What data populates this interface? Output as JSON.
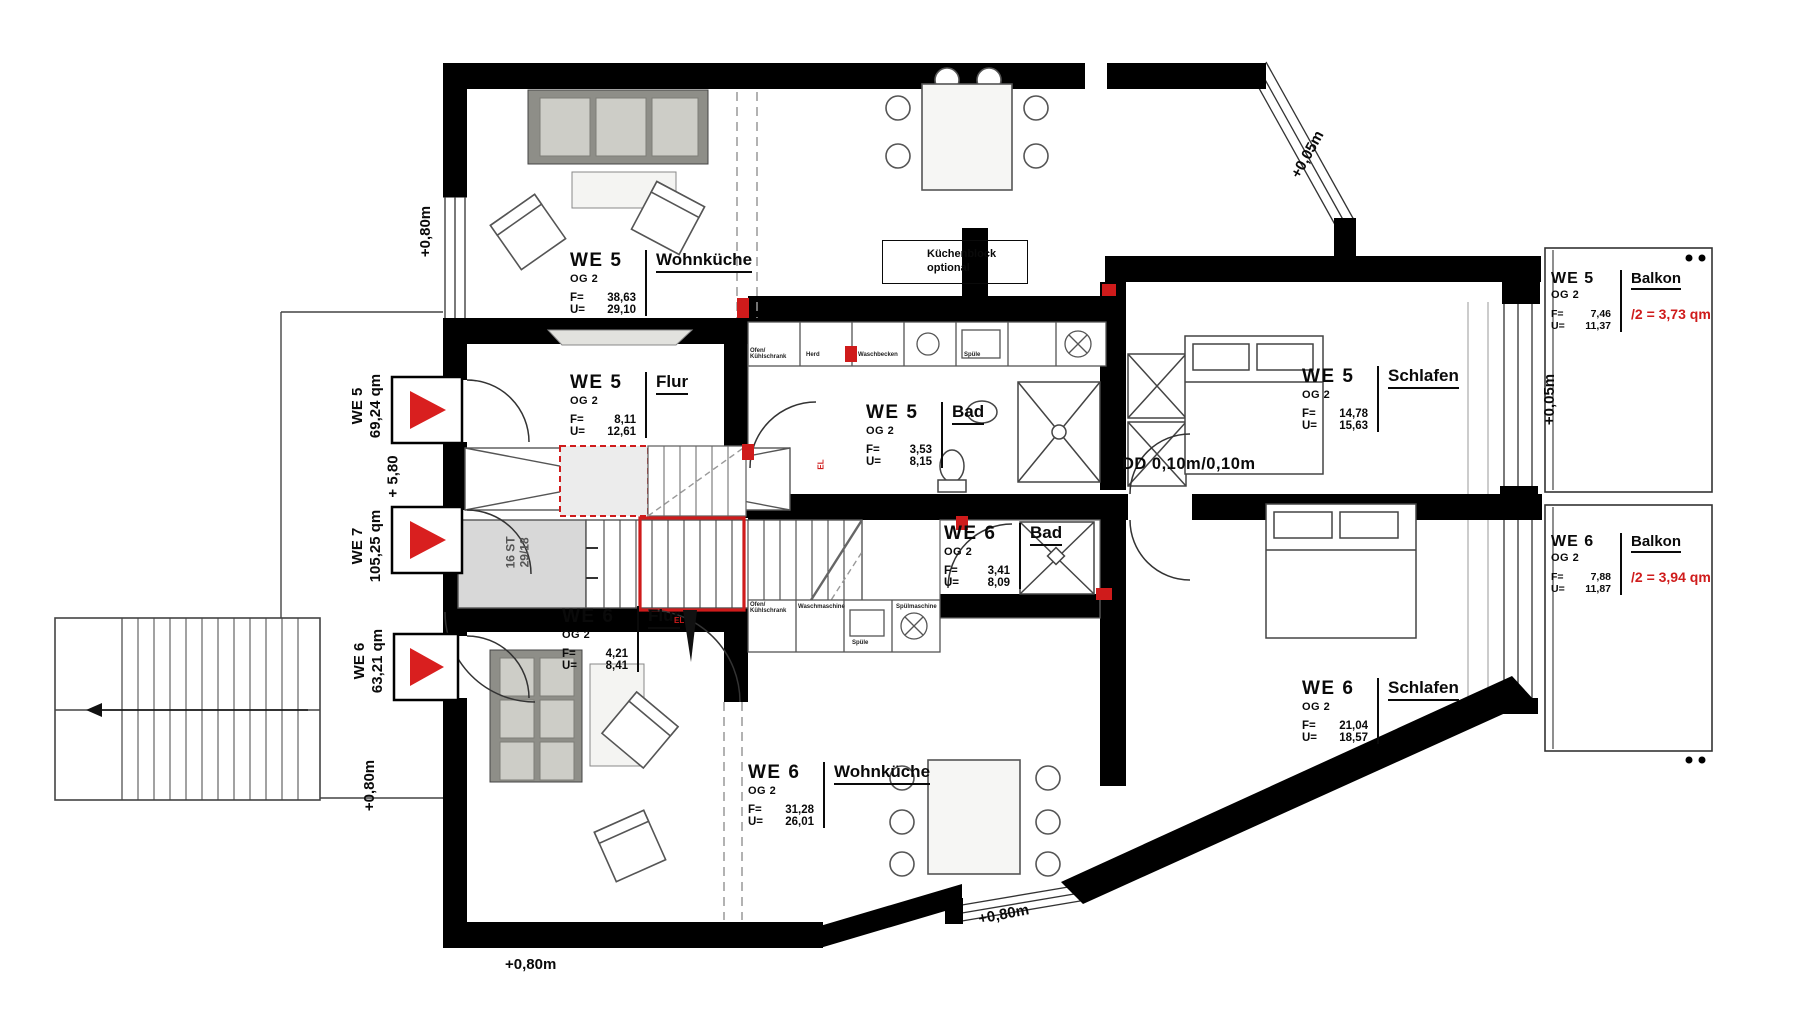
{
  "labels": {
    "f_key": "F=",
    "u_key": "U=",
    "kuechenblock_line1": "Küchenblock",
    "kuechenblock_line2": "optional",
    "dd_note": "DD 0,10m/0,10m",
    "stairs_line1": "16 ST",
    "stairs_line2": "29/18",
    "el": "EL"
  },
  "rooms": [
    {
      "unit": "WE 5",
      "floor": "OG 2",
      "name": "Wohnküche",
      "f": "38,63",
      "u": "29,10"
    },
    {
      "unit": "WE 5",
      "floor": "OG 2",
      "name": "Flur",
      "f": "8,11",
      "u": "12,61"
    },
    {
      "unit": "WE 5",
      "floor": "OG 2",
      "name": "Bad",
      "f": "3,53",
      "u": "8,15"
    },
    {
      "unit": "WE 5",
      "floor": "OG 2",
      "name": "Schlafen",
      "f": "14,78",
      "u": "15,63"
    },
    {
      "unit": "WE 5",
      "floor": "OG 2",
      "name": "Balkon",
      "f": "7,46",
      "u": "11,37",
      "extra": "/2 = 3,73 qm"
    },
    {
      "unit": "WE 6",
      "floor": "OG 2",
      "name": "Balkon",
      "f": "7,88",
      "u": "11,87",
      "extra": "/2 = 3,94 qm"
    },
    {
      "unit": "WE 6",
      "floor": "OG 2",
      "name": "Schlafen",
      "f": "21,04",
      "u": "18,57"
    },
    {
      "unit": "WE 6",
      "floor": "OG 2",
      "name": "Bad",
      "f": "3,41",
      "u": "8,09"
    },
    {
      "unit": "WE 6",
      "floor": "OG 2",
      "name": "Flur",
      "f": "4,21",
      "u": "8,41"
    },
    {
      "unit": "WE 6",
      "floor": "OG 2",
      "name": "Wohnküche",
      "f": "31,28",
      "u": "26,01"
    }
  ],
  "apartments": [
    {
      "unit": "WE 5",
      "area": "69,24 qm"
    },
    {
      "unit": "WE 7",
      "area": "105,25 qm"
    },
    {
      "unit": "WE 6",
      "area": "63,21 qm"
    }
  ],
  "elevations": {
    "top_left": "+0,80m",
    "mid_left": "+ 5,80",
    "bottom_left_v": "+0,80m",
    "bottom_left_h": "+0,80m",
    "bottom_center": "+0,80m",
    "diag_top_right": "+0,05m",
    "right_side": "+0,05m"
  },
  "appliances_top": [
    "Ofen/ Kühlschrank",
    "Herd",
    "Waschbecken",
    "Spüle"
  ],
  "appliances_bottom": [
    "Ofen/ Kühlschrank",
    "Waschmaschine",
    "Spüle",
    "Spülmaschine"
  ],
  "colors": {
    "wall": "#000000",
    "red": "#cf1b1b",
    "furniture_gray": "#8e8e88",
    "light_gray": "#d8d8d8"
  }
}
